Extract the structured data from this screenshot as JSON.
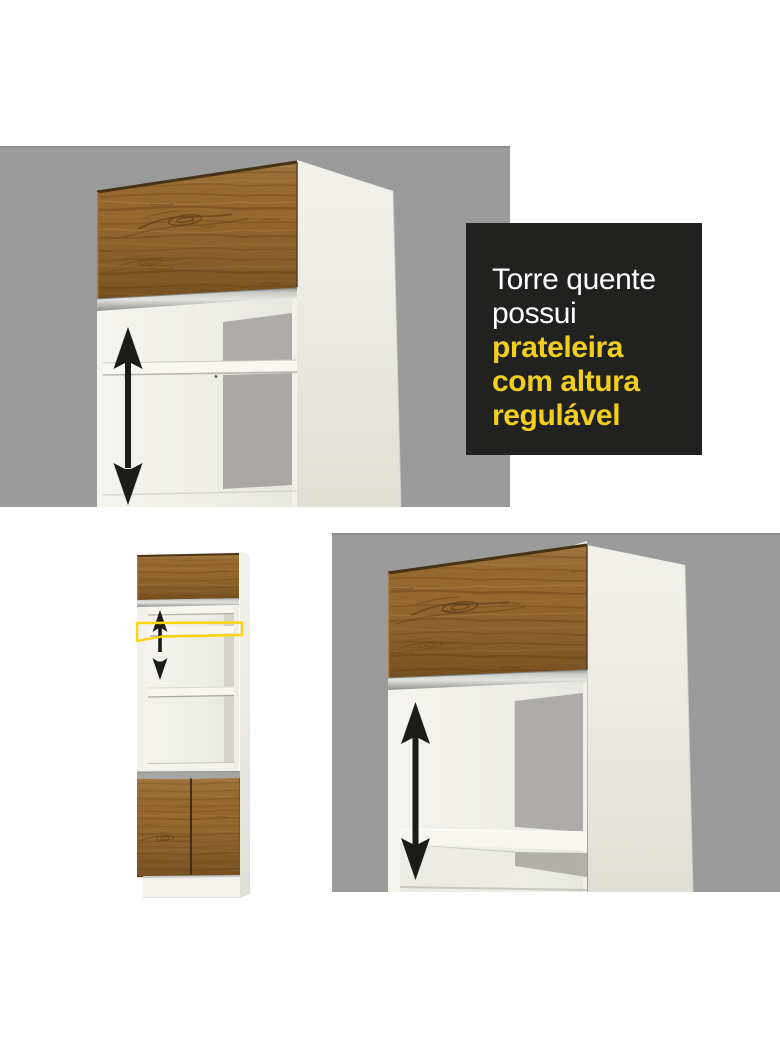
{
  "page": {
    "background_color": "#ffffff",
    "description_texts": []
  },
  "callout": {
    "background_color": "#212120",
    "lines": [
      {
        "text": "Torre quente",
        "color": "#ffffff",
        "emphasis": false
      },
      {
        "text": "possui",
        "color": "#ffffff",
        "emphasis": false
      },
      {
        "text": "prateleira",
        "color": "#f2cf1d",
        "emphasis": true
      },
      {
        "text": "com altura",
        "color": "#f2cf1d",
        "emphasis": true
      },
      {
        "text": "regulável",
        "color": "#f2cf1d",
        "emphasis": true
      }
    ]
  },
  "colors": {
    "backdrop_gray": "#9b9b9b",
    "wood_brown": "#95672e",
    "cabinet_white": "#f2f1ec",
    "interior_shadow_gray": "#adacaa",
    "aluminum_profile": "#c9c9c5",
    "arrow_black": "#1b1b1a",
    "highlight_yellow": "#fdd40e",
    "callout_yellow": "#f2cf1d"
  },
  "icons": {
    "height_adjust_arrow": "double-headed-vertical-arrow",
    "shelf_highlight": "yellow-outline-quad"
  }
}
